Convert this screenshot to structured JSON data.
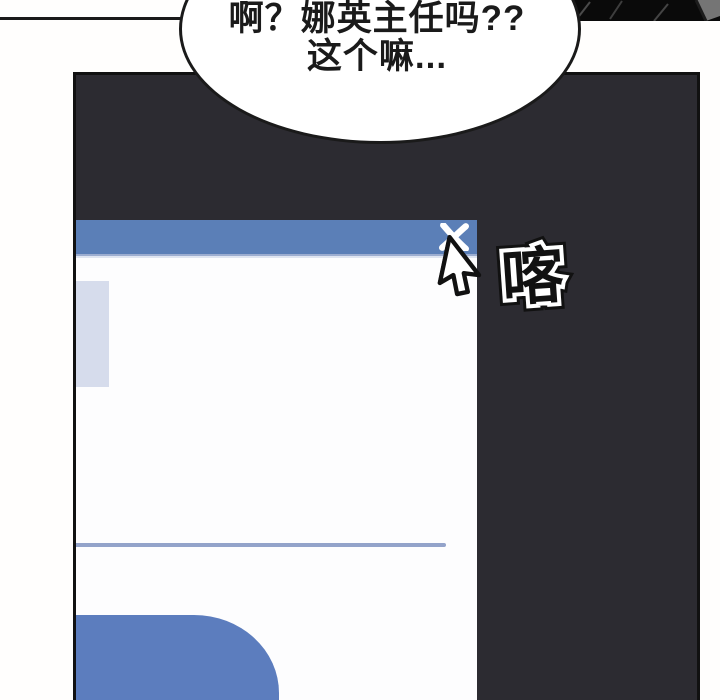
{
  "comic": {
    "speech_bubble": {
      "line1": "啊？娜英主任吗??",
      "line2": "这个嘛..."
    },
    "sfx": {
      "text": "喀",
      "meaning": "click sound effect"
    }
  },
  "dialog_window": {
    "title_text": "",
    "close_icon": "✕",
    "elements": [
      "titlebar",
      "close-button",
      "content-block",
      "divider-line",
      "blue-button-shape"
    ]
  },
  "icons": {
    "close": "x-cross",
    "cursor": "arrow-pointer"
  },
  "colors": {
    "titlebar_blue": "#5b7fb7",
    "panel_dark": "#2c2b31",
    "panel_border": "#111111",
    "dialog_white": "#fdfdfe",
    "accent_blue": "#5c7dbe",
    "lavender_block": "#d6dcec",
    "divider_blue": "#93a3ca",
    "ink_black": "#1a1a1a",
    "sfx_white": "#ffffff"
  }
}
